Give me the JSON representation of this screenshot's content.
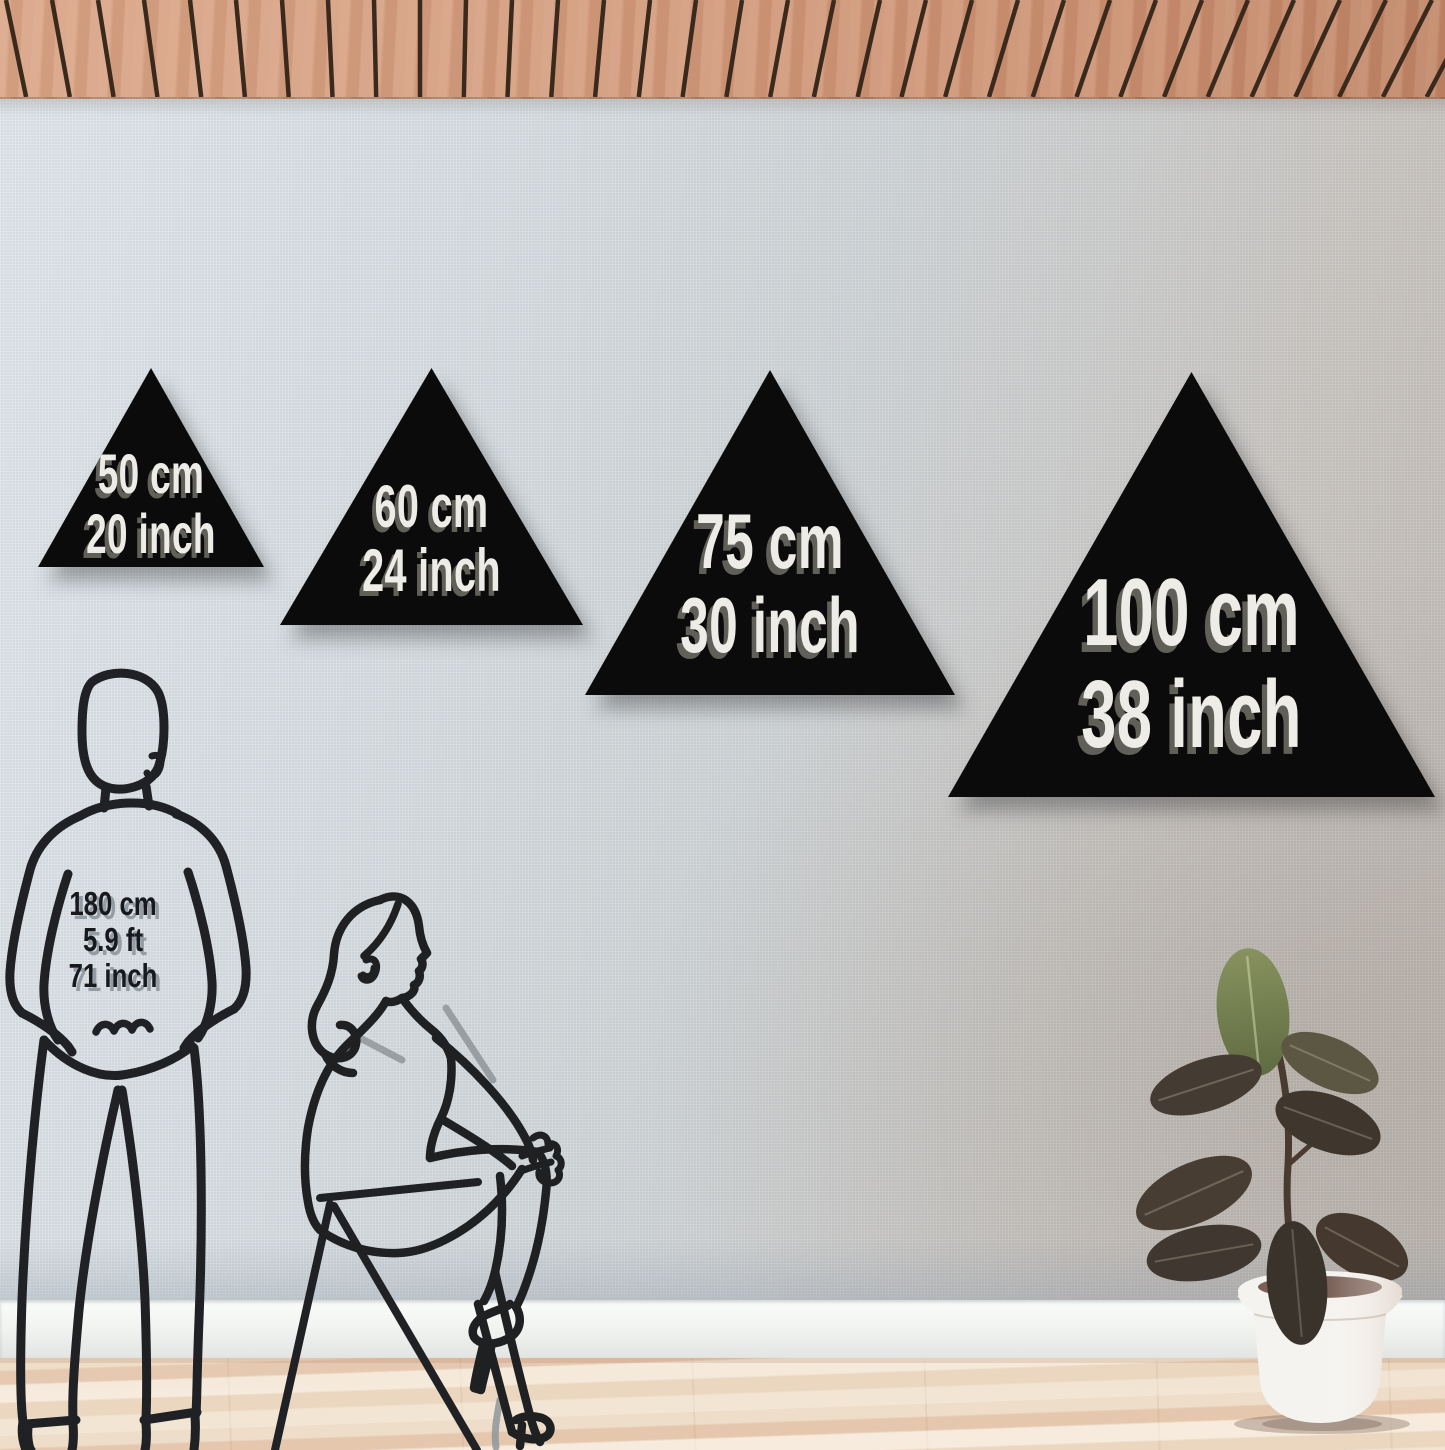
{
  "sizes": [
    {
      "cm": "50 cm",
      "inch": "20 inch"
    },
    {
      "cm": "60 cm",
      "inch": "24 inch"
    },
    {
      "cm": "75 cm",
      "inch": "30 inch"
    },
    {
      "cm": "100 cm",
      "inch": "38 inch"
    }
  ],
  "person": {
    "cm": "180 cm",
    "ft": "5.9 ft",
    "inch": "71 inch"
  },
  "colors": {
    "triangle": "#0b0b0b",
    "triangle_label": "#edece6",
    "triangle_label_shadow": "#6a6a61",
    "person_label": "#17191d",
    "person_label_shadow": "#8a939b",
    "line_art": "#1f2124",
    "ceiling_wood": "#d09779",
    "ceiling_gap": "#3a2a1d",
    "wall": "#d4d8da",
    "baseboard": "#f1f3f1",
    "floor": "#eedec9",
    "pot": "#f5f3ef",
    "soil": "#7a6057",
    "leaf_dark": "#433a31",
    "leaf_green": "#75814f"
  }
}
